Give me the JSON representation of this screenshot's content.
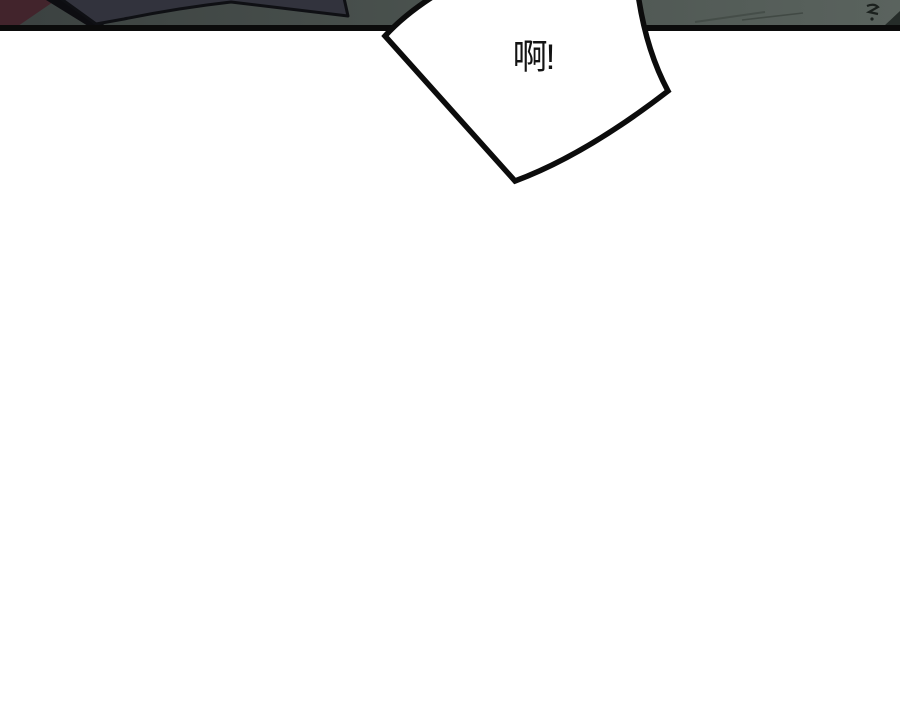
{
  "page": {
    "background_color": "#ffffff"
  },
  "panel": {
    "border_color": "#0b0b0b",
    "bg_left_color": "#3b4140",
    "bg_mid_color": "#4c5450",
    "bg_right_color": "#5a635e",
    "maroon_accent_color": "#42242c",
    "figure_color": "#32333d",
    "figure_outline_color": "#0f1014",
    "scratch_color": "#39413c",
    "debris_color": "#1b211e"
  },
  "bubble": {
    "text": "啊!",
    "fill": "#ffffff",
    "stroke": "#0c0c0c"
  }
}
